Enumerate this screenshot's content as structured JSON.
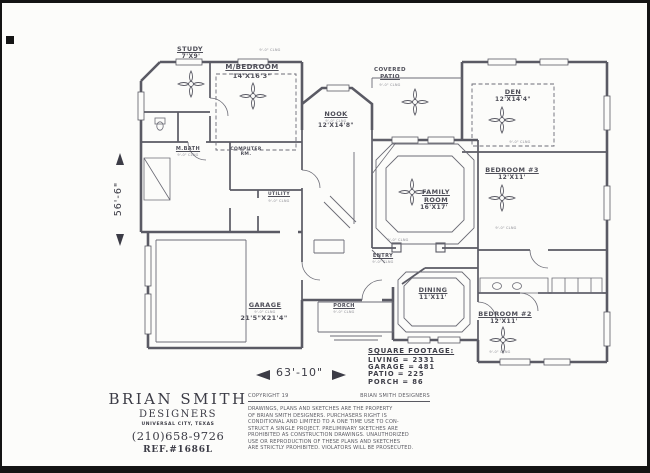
{
  "colors": {
    "paper": "#fcfcfa",
    "ink": "#4e4e58",
    "wall": "#5a5a64",
    "frame": "#141414"
  },
  "rooms": {
    "study": {
      "name": "STUDY",
      "size": "7'X9'"
    },
    "master_bedroom": {
      "name": "M/BEDROOM",
      "size": "14'X16'3\""
    },
    "nook": {
      "name": "NOOK",
      "size": "12'X14'8\""
    },
    "covered_patio": {
      "line1": "COVERED",
      "line2": "PATIO"
    },
    "den": {
      "name": "DEN",
      "size": "12'X14'4\""
    },
    "bedroom3": {
      "name": "BEDROOM #3",
      "size": "12'X11'"
    },
    "family_room": {
      "line1": "FAMILY",
      "line2": "ROOM",
      "size": "16'X17'"
    },
    "dining": {
      "name": "DINING",
      "size": "11'X11'"
    },
    "bedroom2": {
      "name": "BEDROOM #2",
      "size": "12'X11'"
    },
    "garage": {
      "name": "GARAGE",
      "size": "21'5\"X21'4\""
    },
    "porch": {
      "name": "PORCH"
    },
    "entry": {
      "name": "ENTRY"
    },
    "master_bath": {
      "name": "M.BATH"
    },
    "computer_room": {
      "line1": "COMPUTER",
      "line2": "RM."
    },
    "utility": {
      "name": "UTILITY"
    }
  },
  "ceiling_note": "9'-0\" CLNG",
  "dimensions": {
    "height": "56'-6\"",
    "width": "63'-10\""
  },
  "square_footage": {
    "title": "SQUARE FOOTAGE:",
    "rows": [
      "LIVING = 2331",
      "GARAGE = 481",
      "PATIO = 225",
      "PORCH = 86"
    ]
  },
  "title_block": {
    "name": "BRIAN SMITH",
    "subtitle": "DESIGNERS",
    "location": "UNIVERSAL CITY, TEXAS",
    "phone": "(210)658-9726",
    "reference": "REF.#1686L"
  },
  "copyright": {
    "label": "COPYRIGHT 19",
    "owner": "BRIAN SMITH DESIGNERS",
    "body_lines": [
      "DRAWINGS, PLANS AND SKETCHES ARE THE PROPERTY",
      "OF BRIAN SMITH DESIGNERS.  PURCHASERS RIGHT IS",
      "CONDITIONAL AND LIMITED TO A ONE TIME USE TO CON-",
      "STRUCT A SINGLE PROJECT.  PRELIMINARY SKETCHES ARE",
      "PROHIBITED AS CONSTRUCTION DRAWINGS.  UNAUTHORIZED",
      "USE OR REPRODUCTION OF THESE PLANS AND SKETCHES",
      "ARE STRICTLY PROHIBITED.  VIOLATORS WILL BE PROSECUTED."
    ]
  }
}
